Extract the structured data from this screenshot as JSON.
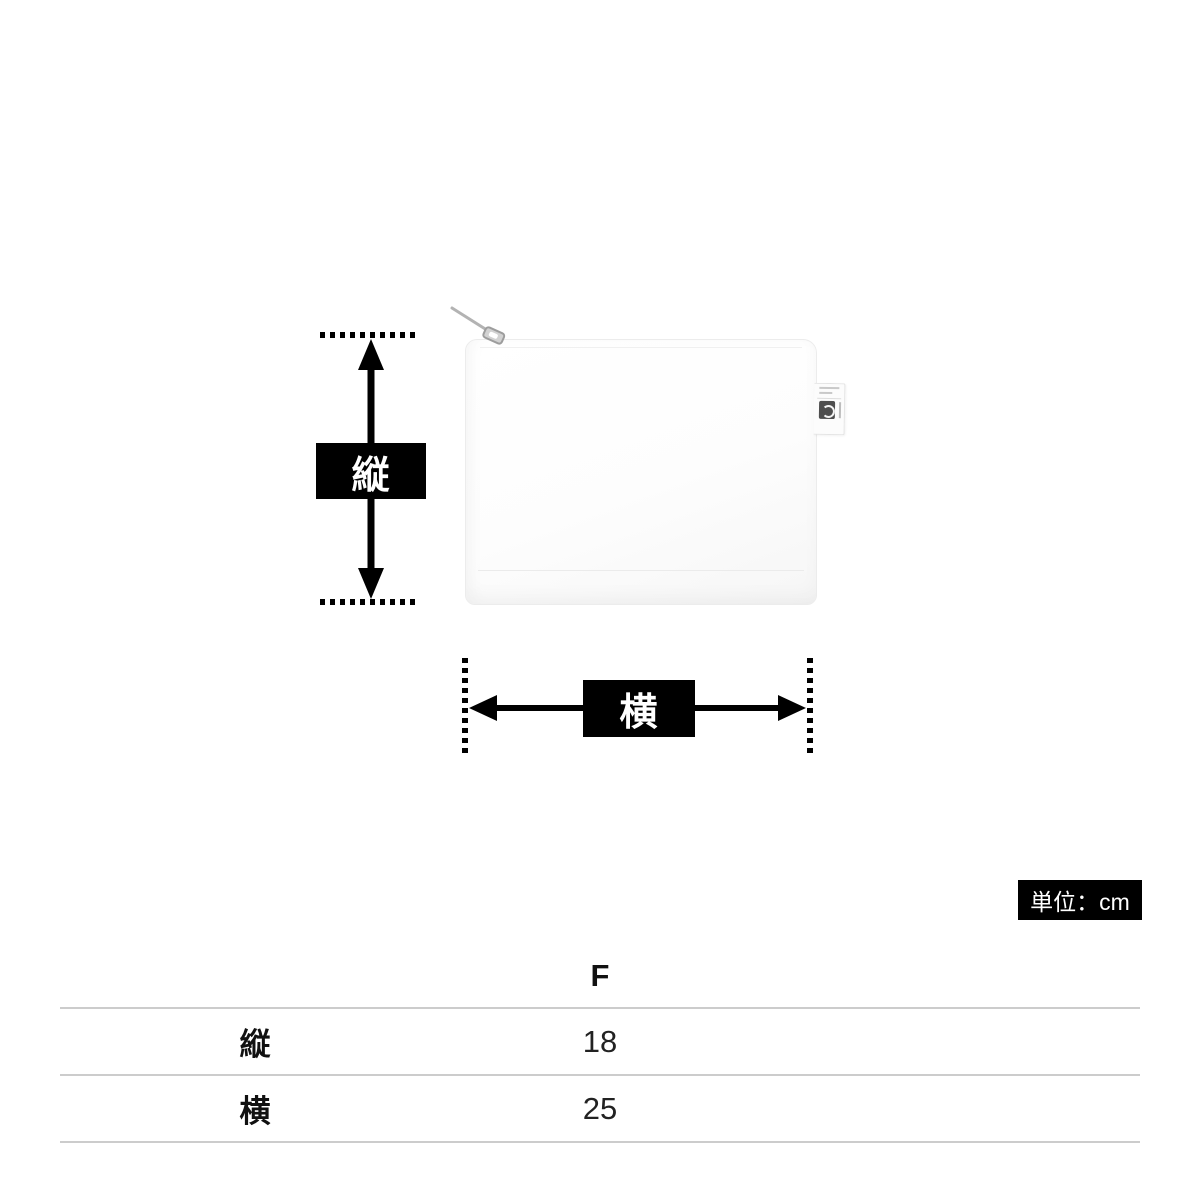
{
  "diagram": {
    "vertical_label": "縦",
    "horizontal_label": "横",
    "unit_label": "単位：cm",
    "arrow_color": "#000000",
    "label_box_color": "#000000",
    "label_text_color": "#ffffff"
  },
  "product": {
    "body_color": "#fdfdfd",
    "tag_logo_color": "#4f4f4f"
  },
  "table": {
    "size_header": "F",
    "rows": [
      {
        "label": "縦",
        "value": "18"
      },
      {
        "label": "横",
        "value": "25"
      }
    ],
    "line_color": "#cccccc"
  }
}
